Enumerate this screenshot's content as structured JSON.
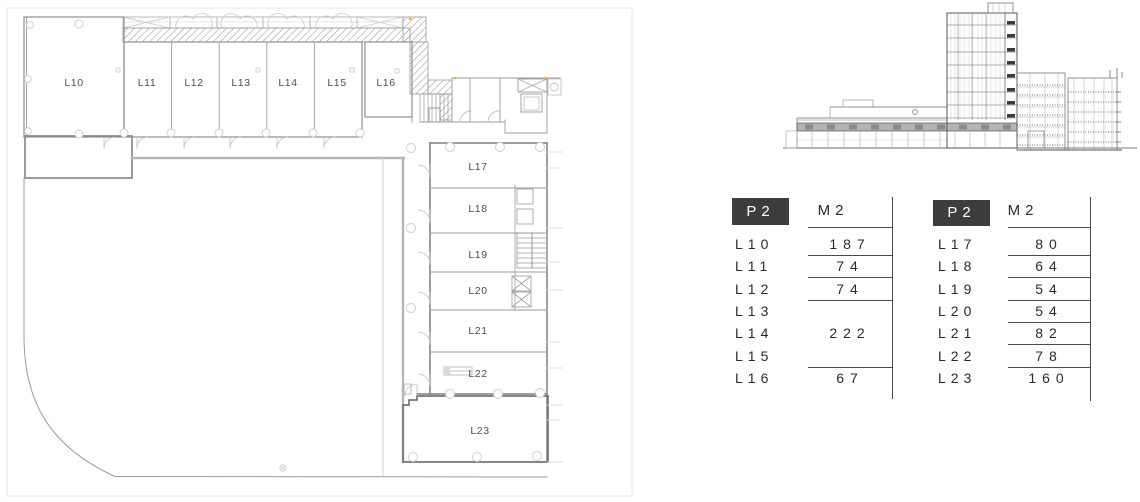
{
  "floor_plan": {
    "top_row_rooms": [
      "L10",
      "L11",
      "L12",
      "L13",
      "L14",
      "L15",
      "L16"
    ],
    "right_column_rooms": [
      "L17",
      "L18",
      "L19",
      "L20",
      "L21",
      "L22",
      "L23"
    ]
  },
  "tables": [
    {
      "floor": "P2",
      "unit": "M2",
      "rows": [
        {
          "room": "L10",
          "area": "187"
        },
        {
          "room": "L11",
          "area": "74"
        },
        {
          "room": "L12",
          "area": "74"
        },
        {
          "room": "L13",
          "area": ""
        },
        {
          "room": "L14",
          "area": "222"
        },
        {
          "room": "L15",
          "area": ""
        },
        {
          "room": "L16",
          "area": "67"
        }
      ]
    },
    {
      "floor": "P2",
      "unit": "M2",
      "rows": [
        {
          "room": "L17",
          "area": "80"
        },
        {
          "room": "L18",
          "area": "64"
        },
        {
          "room": "L19",
          "area": "54"
        },
        {
          "room": "L20",
          "area": "54"
        },
        {
          "room": "L21",
          "area": "82"
        },
        {
          "room": "L22",
          "area": "78"
        },
        {
          "room": "L23",
          "area": "160"
        }
      ]
    }
  ],
  "colors": {
    "header-bg": "#3d3d3d",
    "header-fg": "#ffffff",
    "ink": "#2b2b2b",
    "rule": "#4a4a4a"
  }
}
